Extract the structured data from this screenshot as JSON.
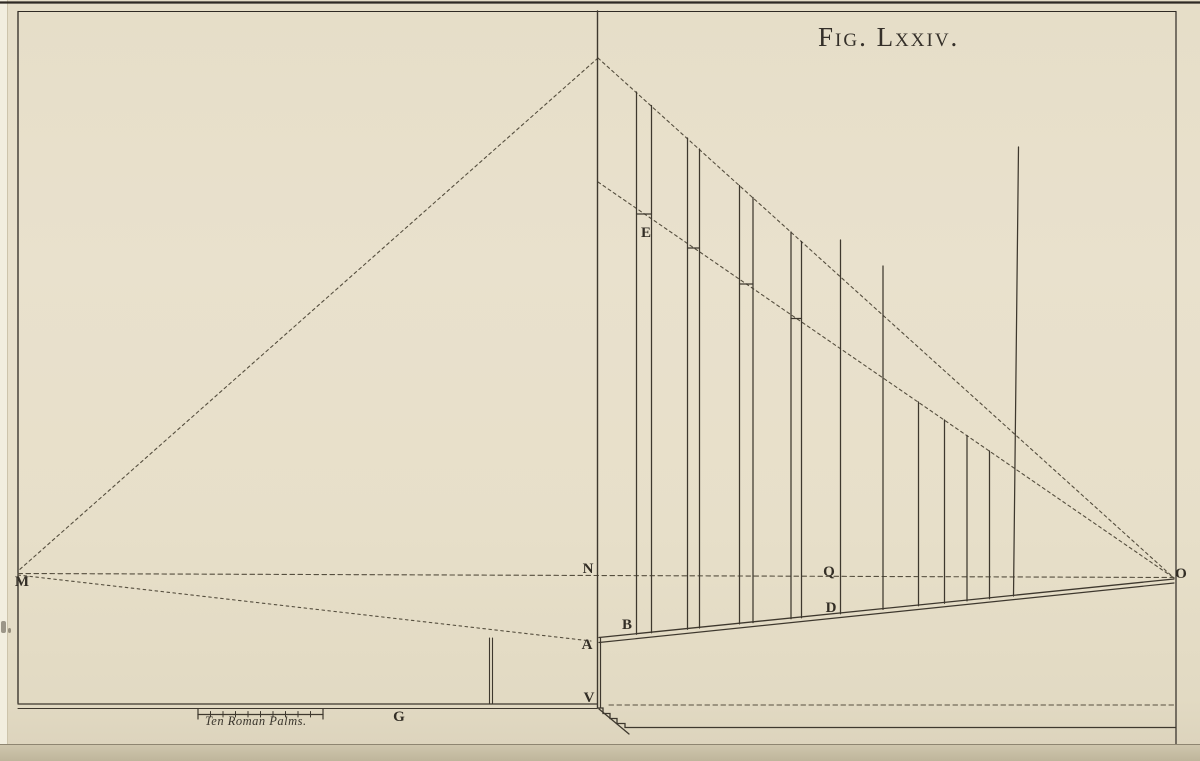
{
  "title": {
    "text": "Fig. Lxxiv."
  },
  "labels": [
    {
      "id": "M",
      "text": "M",
      "x": 22,
      "y": 581
    },
    {
      "id": "N",
      "text": "N",
      "x": 588,
      "y": 568
    },
    {
      "id": "E",
      "text": "E",
      "x": 646,
      "y": 232
    },
    {
      "id": "Q",
      "text": "Q",
      "x": 829,
      "y": 571
    },
    {
      "id": "O",
      "text": "O",
      "x": 1181,
      "y": 573
    },
    {
      "id": "B",
      "text": "B",
      "x": 627,
      "y": 624
    },
    {
      "id": "A",
      "text": "A",
      "x": 587,
      "y": 644
    },
    {
      "id": "V",
      "text": "V",
      "x": 589,
      "y": 697
    },
    {
      "id": "D",
      "text": "D",
      "x": 831,
      "y": 607
    },
    {
      "id": "G",
      "text": "G",
      "x": 399,
      "y": 716
    }
  ],
  "scale_bar": {
    "label": "Ten Roman Palms.",
    "x1": 198,
    "x2": 323,
    "y": 714.5,
    "tick_count": 10
  },
  "colors": {
    "paper": "#e8e0cb",
    "ink": "#3e382e",
    "dash_ink": "#564f3f",
    "border": "#2f2a24",
    "shadow": "#8e8571"
  },
  "figure": {
    "border_lines": [
      {
        "x1": 0,
        "y1": 2.5,
        "x2": 1200,
        "y2": 2.5,
        "w": 2.2
      },
      {
        "x1": 18,
        "y1": 11.5,
        "x2": 1176,
        "y2": 11.5,
        "w": 1.1
      },
      {
        "x1": 18,
        "y1": 11.5,
        "x2": 18,
        "y2": 703,
        "w": 1.3
      },
      {
        "x1": 1176,
        "y1": 11.5,
        "x2": 1176,
        "y2": 746,
        "w": 1.2
      }
    ],
    "dashed_lines": [
      {
        "name": "apex-to-M",
        "x1": 598,
        "y1": 58,
        "x2": 18,
        "y2": 571,
        "dash": "3 3.2"
      },
      {
        "name": "apex-to-O",
        "x1": 598,
        "y1": 58,
        "x2": 1174,
        "y2": 578,
        "dash": "3 3.2"
      },
      {
        "name": "horizon-M-N-Q-O",
        "x1": 18,
        "y1": 573.5,
        "x2": 1174,
        "y2": 577.5,
        "dash": "4.5 3.5"
      },
      {
        "name": "E-line-to-O",
        "x1": 598,
        "y1": 182,
        "x2": 1174,
        "y2": 578,
        "dash": "3 3.2"
      },
      {
        "name": "M-to-A",
        "x1": 18,
        "y1": 575,
        "x2": 591,
        "y2": 641,
        "dash": "2.5 3.5"
      },
      {
        "name": "base-level-right",
        "x1": 609,
        "y1": 705,
        "x2": 1176,
        "y2": 705,
        "dash": "4.5 3.5"
      }
    ],
    "solid_lines": [
      {
        "name": "center-vertical",
        "x1": 597.5,
        "y1": 11,
        "x2": 597.5,
        "y2": 708,
        "w": 1.4
      },
      {
        "name": "wall-inner-vertical",
        "x1": 600.5,
        "y1": 638,
        "x2": 600.5,
        "y2": 708,
        "w": 1.2
      },
      {
        "name": "ground-upper",
        "x1": 599,
        "y1": 637.5,
        "x2": 1174,
        "y2": 579,
        "w": 1.3
      },
      {
        "name": "ground-lower",
        "x1": 599,
        "y1": 642.5,
        "x2": 1174,
        "y2": 583,
        "w": 1.2
      },
      {
        "name": "left-base-upper",
        "x1": 18,
        "y1": 704,
        "x2": 597,
        "y2": 704,
        "w": 1.3
      },
      {
        "name": "left-base-lower",
        "x1": 18,
        "y1": 708.5,
        "x2": 597,
        "y2": 708.5,
        "w": 1.1
      },
      {
        "name": "plan-gnomon-left",
        "x1": 489.5,
        "y1": 638,
        "x2": 489.5,
        "y2": 704,
        "w": 1.1
      },
      {
        "name": "plan-gnomon-right",
        "x1": 492.5,
        "y1": 638,
        "x2": 492.5,
        "y2": 704,
        "w": 1.1
      },
      {
        "name": "step-ramp",
        "x1": 599,
        "y1": 709,
        "x2": 629,
        "y2": 734,
        "w": 1.3
      }
    ],
    "steps_polyline": "597,708 603,708 603,713.5 610,713.5 610,718.5 617,718.5 617,723.5 625,723.5 625,727.5 1176,727.5",
    "poles": [
      [
        636.5,
        92,
        636.5,
        634.2
      ],
      [
        651.5,
        105.5,
        651.5,
        632.8
      ],
      [
        687.5,
        138,
        687.5,
        629.2
      ],
      [
        699.5,
        149,
        699.5,
        628
      ],
      [
        739.5,
        185.5,
        739.5,
        623.9
      ],
      [
        753,
        197.5,
        753,
        622.6
      ],
      [
        791,
        232,
        791,
        618.7
      ],
      [
        801.5,
        241.5,
        801.5,
        617.7
      ],
      [
        840.5,
        240,
        840.5,
        613.7
      ],
      [
        883,
        266,
        883,
        609.4
      ],
      [
        918.5,
        402,
        918.5,
        605.8
      ],
      [
        944.5,
        420,
        944.5,
        603.2
      ],
      [
        967,
        435.5,
        967,
        600.9
      ],
      [
        989.5,
        451,
        989.5,
        598.7
      ],
      [
        1018.5,
        147,
        1013.5,
        596
      ]
    ],
    "pole_ticks": [
      [
        636.5,
        651.5,
        214
      ],
      [
        687.5,
        699.5,
        248
      ],
      [
        739.5,
        753,
        284
      ],
      [
        791,
        801.5,
        318.5
      ]
    ],
    "specks": [
      {
        "x": 1,
        "y": 621,
        "w": 5,
        "h": 12
      },
      {
        "x": 8,
        "y": 628,
        "w": 3,
        "h": 5
      }
    ]
  }
}
